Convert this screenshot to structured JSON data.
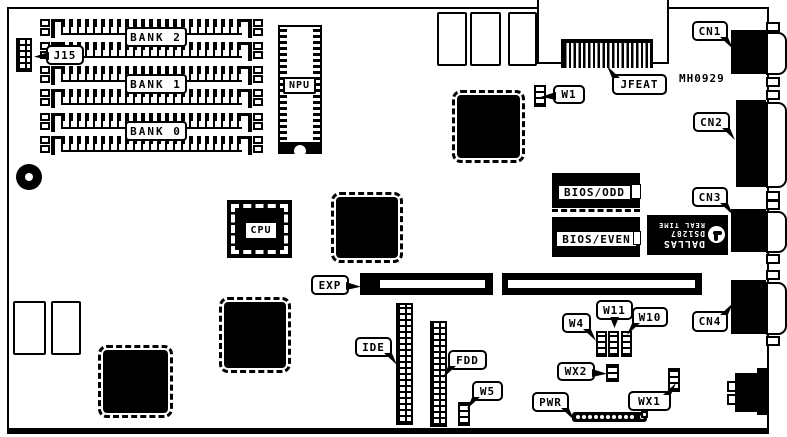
{
  "diagram": {
    "type": "motherboard-layout",
    "board_id": "MH0929",
    "colors": {
      "foreground": "#000000",
      "background": "#ffffff"
    }
  },
  "labels": {
    "bank2": "BANK 2",
    "bank1": "BANK 1",
    "bank0": "BANK 0",
    "j15": "J15",
    "npu": "NPU",
    "cpu": "CPU",
    "exp": "EXP",
    "ide": "IDE",
    "fdd": "FDD",
    "jfeat": "JFEAT",
    "w1": "W1",
    "w4": "W4",
    "w5": "W5",
    "w10": "W10",
    "w11": "W11",
    "wx1": "WX1",
    "wx2": "WX2",
    "pwr": "PWR",
    "cn1": "CN1",
    "cn2": "CN2",
    "cn3": "CN3",
    "cn4": "CN4",
    "bios_odd": "BIOS/ODD",
    "bios_even": "BIOS/EVEN",
    "part_number": "MH0929",
    "rtc_brand": "DALLAS",
    "rtc_model": "DS1287",
    "rtc_type": "REAL TIME"
  }
}
